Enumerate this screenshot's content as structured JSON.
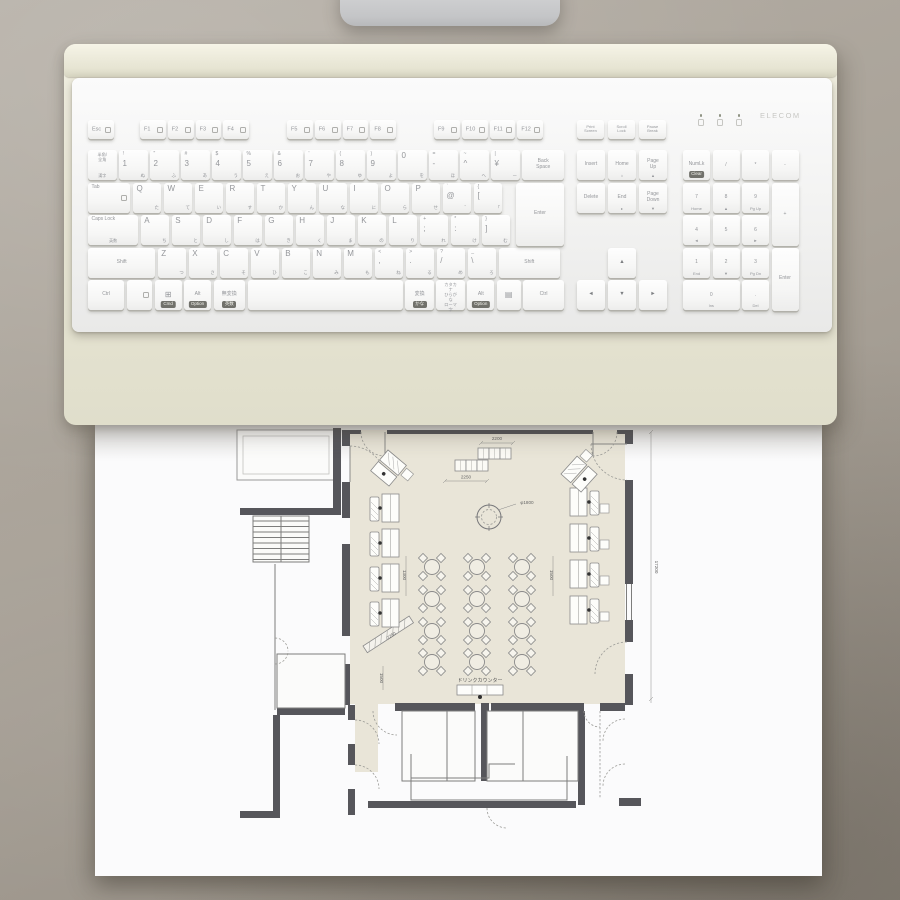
{
  "colors": {
    "background": "#a9a298",
    "tray": "#e9e7d6",
    "keyboard_body": "#f4f4f3",
    "key_text": "#94969a",
    "badge_bg": "#71716b",
    "paper": "#fbfbfc",
    "plan_wall": "#56565b",
    "plan_floor": "#e9e5d8",
    "plan_line": "#8a8a8a",
    "monitor_stand": "#cbccce"
  },
  "keyboard": {
    "brand": "ELECOM",
    "indicators": [
      "num-lock-indicator",
      "caps-lock-indicator",
      "scroll-lock-indicator"
    ],
    "esc": {
      "m": "Esc",
      "n": "esc",
      "ico": true
    },
    "fgroups": [
      [
        {
          "m": "F1",
          "ico": true
        },
        {
          "m": "F2",
          "ico": true
        },
        {
          "m": "F3",
          "ico": true
        },
        {
          "m": "F4",
          "ico": true
        }
      ],
      [
        {
          "m": "F5",
          "ico": true
        },
        {
          "m": "F6",
          "ico": true
        },
        {
          "m": "F7",
          "ico": true
        },
        {
          "m": "F8",
          "ico": true
        }
      ],
      [
        {
          "m": "F9",
          "ico": true
        },
        {
          "m": "F10",
          "ico": true
        },
        {
          "m": "F11",
          "ico": true
        },
        {
          "m": "F12",
          "ico": true
        }
      ]
    ],
    "system_keys": [
      {
        "m": "Print\nScreen",
        "n": "print-screen"
      },
      {
        "m": "Scroll\nLock",
        "n": "scroll-lock"
      },
      {
        "m": "Pause\nBreak",
        "n": "pause-break"
      }
    ],
    "nav_rows": [
      [
        {
          "m": "Insert",
          "n": "insert",
          "small": true,
          "ctr": true
        },
        {
          "m": "Home",
          "n": "home",
          "small": true,
          "ctr": true,
          "k2": "⌂"
        },
        {
          "m": "Page\nUp",
          "n": "page-up",
          "small": true,
          "ctr": true,
          "k2": "▲"
        }
      ],
      [
        {
          "m": "Delete",
          "n": "delete",
          "small": true,
          "ctr": true
        },
        {
          "m": "End",
          "n": "end",
          "small": true,
          "ctr": true,
          "k2": "▸"
        },
        {
          "m": "Page\nDown",
          "n": "page-down",
          "small": true,
          "ctr": true,
          "k2": "▼"
        }
      ]
    ],
    "rows": [
      {
        "keys": [
          {
            "lines": "半角/\n全角",
            "k2": "漢字",
            "n": "hankaku-zenkaku"
          },
          {
            "s": "!",
            "m": "1",
            "k": "ぬ"
          },
          {
            "s": "\"",
            "m": "2",
            "k": "ふ"
          },
          {
            "s": "#",
            "m": "3",
            "k": "あ"
          },
          {
            "s": "$",
            "m": "4",
            "k": "う"
          },
          {
            "s": "%",
            "m": "5",
            "k": "え"
          },
          {
            "s": "&",
            "m": "6",
            "k": "お"
          },
          {
            "s": "'",
            "m": "7",
            "k": "や"
          },
          {
            "s": "(",
            "m": "8",
            "k": "ゆ"
          },
          {
            "s": ")",
            "m": "9",
            "k": "よ"
          },
          {
            "m": "0",
            "k": "を",
            "n": "0"
          },
          {
            "s": "=",
            "m": "-",
            "k": "ほ",
            "n": "minus"
          },
          {
            "s": "~",
            "m": "^",
            "k": "へ",
            "n": "caret"
          },
          {
            "s": "|",
            "m": "¥",
            "k": "ー",
            "n": "yen"
          },
          {
            "m": "Back\nSpace",
            "w": 1.45,
            "small": true,
            "ctr": true,
            "n": "backspace"
          }
        ]
      },
      {
        "keys": [
          {
            "m": "Tab",
            "w": 1.45,
            "small": true,
            "n": "tab",
            "ico": true
          },
          {
            "m": "Q",
            "k": "た"
          },
          {
            "m": "W",
            "k": "て"
          },
          {
            "m": "E",
            "k": "い"
          },
          {
            "m": "R",
            "k": "す"
          },
          {
            "m": "T",
            "k": "か"
          },
          {
            "m": "Y",
            "k": "ん"
          },
          {
            "m": "U",
            "k": "な"
          },
          {
            "m": "I",
            "k": "に"
          },
          {
            "m": "O",
            "k": "ら"
          },
          {
            "m": "P",
            "k": "せ"
          },
          {
            "s": "`",
            "m": "@",
            "k": "゛",
            "n": "at"
          },
          {
            "s": "{",
            "m": "[",
            "k": "「",
            "n": "lbracket"
          }
        ]
      },
      {
        "keys": [
          {
            "m": "Caps Lock",
            "k2": "英数",
            "w": 1.7,
            "small": true,
            "n": "caps-lock"
          },
          {
            "m": "A",
            "k": "ち"
          },
          {
            "m": "S",
            "k": "と"
          },
          {
            "m": "D",
            "k": "し"
          },
          {
            "m": "F",
            "k": "は"
          },
          {
            "m": "G",
            "k": "き"
          },
          {
            "m": "H",
            "k": "く"
          },
          {
            "m": "J",
            "k": "ま"
          },
          {
            "m": "K",
            "k": "の"
          },
          {
            "m": "L",
            "k": "り"
          },
          {
            "s": "+",
            "m": ";",
            "k": "れ",
            "n": "semicolon"
          },
          {
            "s": "*",
            "m": ":",
            "k": "け",
            "n": "colon"
          },
          {
            "s": "}",
            "m": "]",
            "k": "む",
            "n": "rbracket"
          }
        ]
      },
      {
        "keys": [
          {
            "m": "Shift",
            "w": 2.25,
            "small": true,
            "ctr": true,
            "n": "shift-left"
          },
          {
            "m": "Z",
            "k": "つ"
          },
          {
            "m": "X",
            "k": "さ"
          },
          {
            "m": "C",
            "k": "そ"
          },
          {
            "m": "V",
            "k": "ひ"
          },
          {
            "m": "B",
            "k": "こ"
          },
          {
            "m": "N",
            "k": "み"
          },
          {
            "m": "M",
            "k": "も"
          },
          {
            "s": "<",
            "m": ",",
            "k": "ね",
            "n": "comma"
          },
          {
            "s": ">",
            "m": ".",
            "k": "る",
            "n": "period"
          },
          {
            "s": "?",
            "m": "/",
            "k": "め",
            "n": "slash"
          },
          {
            "s": "_",
            "m": "\\",
            "k": "ろ",
            "n": "backslash"
          },
          {
            "m": "Shift",
            "w": 2.05,
            "small": true,
            "ctr": true,
            "n": "shift-right"
          }
        ]
      },
      {
        "keys": [
          {
            "m": "Ctrl",
            "w": 1.25,
            "small": true,
            "ctr": true,
            "n": "ctrl-left"
          },
          {
            "w": 0.9,
            "n": "fn",
            "ico": true
          },
          {
            "m": "⊞",
            "b": "Cmd",
            "w": 0.95,
            "ctr": true,
            "n": "win"
          },
          {
            "m": "Alt",
            "b": "Option",
            "w": 0.95,
            "small": true,
            "ctr": true,
            "n": "alt-left"
          },
          {
            "m": "無変換",
            "b": "英数",
            "w": 1.1,
            "small": true,
            "ctr": true,
            "n": "muhenkan"
          },
          {
            "sp": true,
            "n": "space"
          },
          {
            "m": "変換",
            "b": "かな",
            "w": 1.0,
            "small": true,
            "ctr": true,
            "n": "henkan"
          },
          {
            "lines": "カタカナ\nひらがな\nローマ字",
            "w": 1.0,
            "n": "katakana-hiragana"
          },
          {
            "m": "Alt",
            "b": "Option",
            "w": 0.95,
            "small": true,
            "ctr": true,
            "n": "alt-right"
          },
          {
            "m": "▤",
            "w": 0.85,
            "ctr": true,
            "n": "menu"
          },
          {
            "m": "Ctrl",
            "w": 1.4,
            "small": true,
            "ctr": true,
            "n": "ctrl-right"
          }
        ]
      }
    ],
    "enter_main": {
      "m": "Enter",
      "n": "enter"
    },
    "numpad": [
      {
        "m": "NumLk",
        "b": "Clear",
        "c": 0,
        "r": 0,
        "small": true,
        "ctr": true,
        "n": "num-lock"
      },
      {
        "m": "/",
        "c": 1,
        "r": 0,
        "ctr": true,
        "n": "numpad-slash"
      },
      {
        "m": "*",
        "c": 2,
        "r": 0,
        "ctr": true,
        "n": "numpad-asterisk"
      },
      {
        "m": "-",
        "c": 3,
        "r": 0,
        "ctr": true,
        "n": "numpad-minus"
      },
      {
        "m": "7",
        "k2": "Home",
        "c": 0,
        "r": 1,
        "ctr": true,
        "n": "numpad-7"
      },
      {
        "m": "8",
        "k2": "▲",
        "c": 1,
        "r": 1,
        "ctr": true,
        "n": "numpad-8"
      },
      {
        "m": "9",
        "k2": "Pg Up",
        "c": 2,
        "r": 1,
        "ctr": true,
        "n": "numpad-9"
      },
      {
        "m": "+",
        "c": 3,
        "r": 1,
        "tall": true,
        "ctr": true,
        "n": "numpad-plus"
      },
      {
        "m": "4",
        "k2": "◄",
        "c": 0,
        "r": 2,
        "ctr": true,
        "n": "numpad-4"
      },
      {
        "m": "5",
        "c": 1,
        "r": 2,
        "ctr": true,
        "n": "numpad-5"
      },
      {
        "m": "6",
        "k2": "►",
        "c": 2,
        "r": 2,
        "ctr": true,
        "n": "numpad-6"
      },
      {
        "m": "1",
        "k2": "End",
        "c": 0,
        "r": 3,
        "ctr": true,
        "n": "numpad-1"
      },
      {
        "m": "2",
        "k2": "▼",
        "c": 1,
        "r": 3,
        "ctr": true,
        "n": "numpad-2"
      },
      {
        "m": "3",
        "k2": "Pg Dn",
        "c": 2,
        "r": 3,
        "ctr": true,
        "n": "numpad-3"
      },
      {
        "m": "Enter",
        "c": 3,
        "r": 3,
        "tall": true,
        "small": true,
        "ctr": true,
        "n": "numpad-enter"
      },
      {
        "m": "0",
        "k2": "Ins",
        "c": 0,
        "r": 4,
        "wide": true,
        "ctr": true,
        "n": "numpad-0"
      },
      {
        "m": ".",
        "k2": "Del",
        "c": 2,
        "r": 4,
        "ctr": true,
        "n": "numpad-period"
      }
    ],
    "arrows": [
      {
        "m": "▲",
        "c": 1,
        "r": 3,
        "n": "arrow-up"
      },
      {
        "m": "◄",
        "c": 0,
        "r": 4,
        "n": "arrow-left"
      },
      {
        "m": "▼",
        "c": 1,
        "r": 4,
        "n": "arrow-down"
      },
      {
        "m": "►",
        "c": 2,
        "r": 4,
        "n": "arrow-right"
      }
    ]
  },
  "floor_plan": {
    "drink_counter_label": "ドリンクカウンター",
    "dimensions": [
      {
        "text": "2200",
        "x": 402,
        "y": 16,
        "r": 0
      },
      {
        "text": "2250",
        "x": 371,
        "y": 54.5,
        "r": 0
      },
      {
        "text": "φ1800",
        "x": 432,
        "y": 80,
        "r": 0
      },
      {
        "text": "1300",
        "x": 308,
        "y": 151,
        "r": 90
      },
      {
        "text": "1500",
        "x": 455,
        "y": 151,
        "r": 90
      },
      {
        "text": "17200",
        "x": 560,
        "y": 143,
        "r": 90
      },
      {
        "text": "2250",
        "x": 297,
        "y": 213,
        "r": -33
      },
      {
        "text": "1500",
        "x": 285,
        "y": 254,
        "r": 90
      }
    ],
    "tables": {
      "cols": [
        337,
        382,
        427
      ],
      "rows": [
        143,
        175,
        207,
        238
      ]
    },
    "booths_left": [
      [
        275,
        70
      ],
      [
        275,
        105
      ],
      [
        275,
        140
      ],
      [
        275,
        175
      ]
    ],
    "booths_right": [
      [
        475,
        64
      ],
      [
        475,
        100
      ],
      [
        475,
        136
      ],
      [
        475,
        172
      ]
    ],
    "diag_booths": [
      {
        "x": 293,
        "y": 26,
        "r": 40
      },
      {
        "x": 466,
        "y": 50,
        "r": -48
      }
    ],
    "counter_squares": [
      [
        383,
        24
      ],
      [
        394,
        24
      ],
      [
        405,
        24
      ],
      [
        360,
        36
      ],
      [
        371,
        36
      ],
      [
        382,
        36
      ]
    ],
    "column_circle": {
      "cx": 394,
      "cy": 93,
      "r": 12
    }
  }
}
